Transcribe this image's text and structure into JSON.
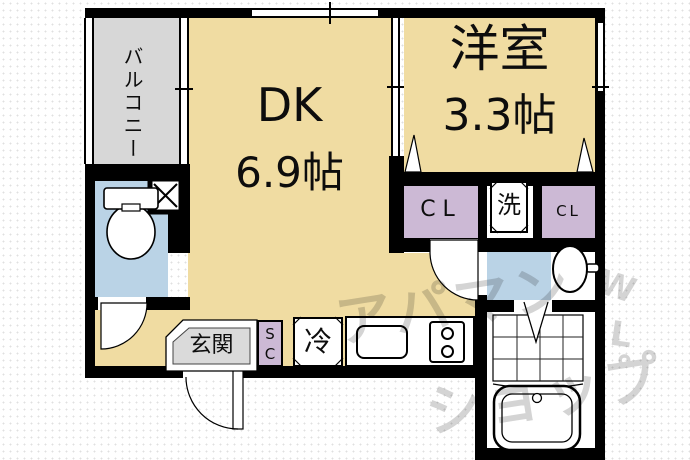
{
  "plan": {
    "balcony": {
      "label": "バルコニー"
    },
    "dk": {
      "name": "DK",
      "size": "6.9帖"
    },
    "western_room": {
      "name": "洋室",
      "size": "3.3帖"
    },
    "closet_left": {
      "label": "CL"
    },
    "closet_right": {
      "label": "CL"
    },
    "laundry": {
      "label": "洗"
    },
    "refrigerator": {
      "label": "冷"
    },
    "shoe_closet": {
      "line1": "S",
      "line2": "C"
    },
    "entrance": {
      "label": "玄関"
    }
  },
  "watermark": {
    "line1": "アパマン",
    "line2": "ショップ",
    "mark1": "W",
    "mark2": "L",
    "mark3": "゜"
  },
  "colors": {
    "room_tan": "#F0DCA2",
    "balcony_gray": "#D7D7D7",
    "water_blue": "#BAD3E6",
    "closet_lavender": "#CCB9D5",
    "entrance_gray": "#DADADA",
    "wall": "#000000",
    "watermark": "#D4D4D4"
  }
}
